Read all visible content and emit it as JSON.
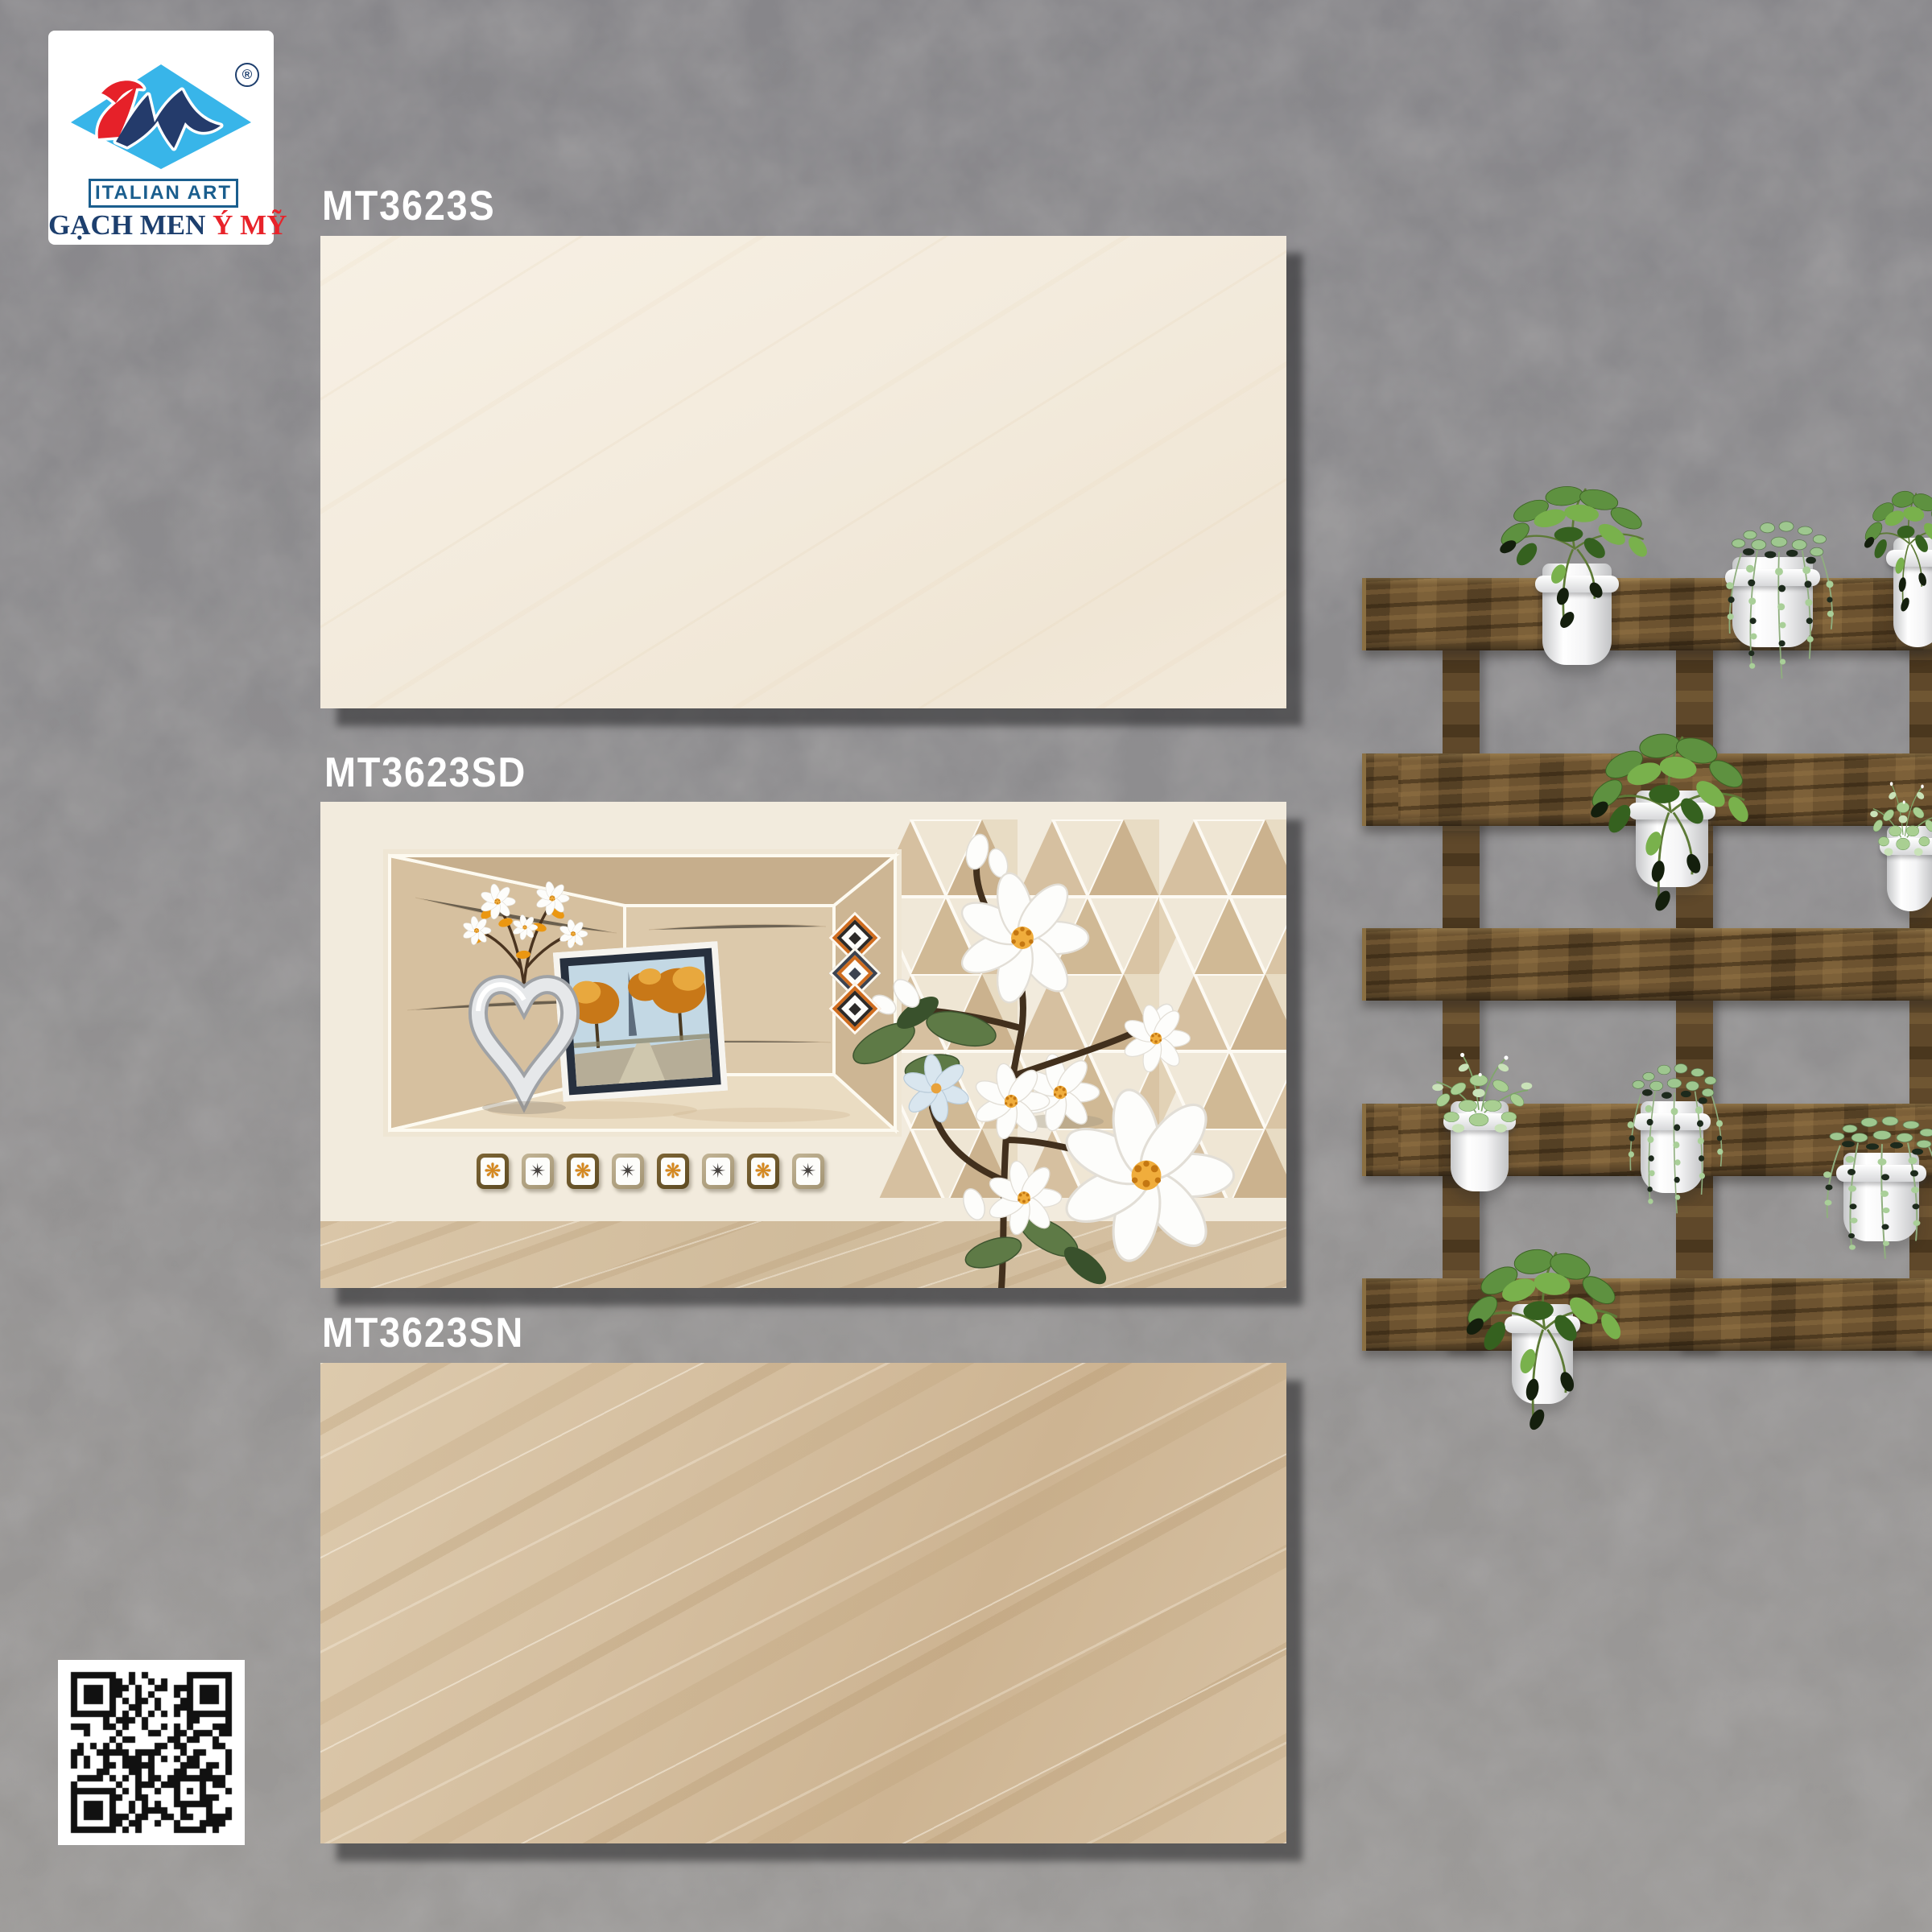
{
  "logo": {
    "registered_mark": "®",
    "banner": "ITALIAN ART",
    "brand_prefix": "GẠCH MEN",
    "brand_name": "Ý MỸ",
    "colors": {
      "diamond_blue": "#38b5e9",
      "swoosh_red": "#e62129",
      "monogram_navy": "#243b6b",
      "banner_blue": "#1a5e8e",
      "brand_red": "#e8232a",
      "brand_navy": "#1d3f6e"
    }
  },
  "products": [
    {
      "code": "MT3623S"
    },
    {
      "code": "MT3623SD"
    },
    {
      "code": "MT3623SN"
    }
  ],
  "decor_tile": {
    "mosaic": [
      {
        "name": "orange-flower-motif",
        "glyph": "❋"
      },
      {
        "name": "gray-star-motif",
        "glyph": "✴"
      },
      {
        "name": "orange-flower-motif",
        "glyph": "❋"
      },
      {
        "name": "gray-star-motif",
        "glyph": "✴"
      },
      {
        "name": "orange-flower-motif",
        "glyph": "❋"
      },
      {
        "name": "gray-star-motif",
        "glyph": "✴"
      },
      {
        "name": "orange-flower-motif",
        "glyph": "❋"
      },
      {
        "name": "gray-star-motif",
        "glyph": "✴"
      }
    ],
    "diamond_ornaments": [
      "orange",
      "slate",
      "orange"
    ]
  },
  "palette": {
    "wall_gray": "#8f8e90",
    "tile_plain_cream": "#f3ecdf",
    "tile_decor_base": "#f2ebdd",
    "tile_dark_beige": "#d5c0a2",
    "decor_band_beige": "#d5c1a3",
    "wood_brown": "#6d5330",
    "pot_white": "#f4f4f5",
    "leaf_green": "#5d9338"
  }
}
